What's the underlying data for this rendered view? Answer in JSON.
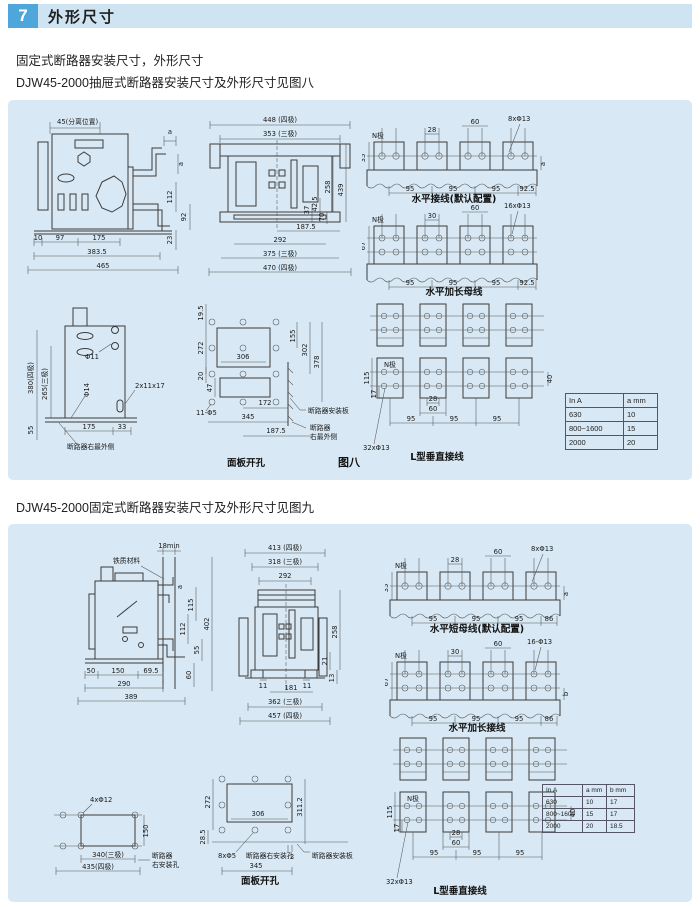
{
  "page": {
    "section_number": "7",
    "section_title": "外形尺寸",
    "intro_line1": "固定式断路器安装尺寸，外形尺寸",
    "intro_line2": "DJW45-2000抽屉式断路器安装尺寸及外形尺寸见图八",
    "mid_line": "DJW45-2000固定式断路器安装尺寸及外形尺寸见图九"
  },
  "colors": {
    "accent": "#4fa6da",
    "header_bg": "#cfe4f2",
    "panel_bg": "#d8e9f5"
  },
  "fig8": {
    "caption": "图八",
    "side": {
      "sep": "45(分离位置)",
      "a1": "a",
      "a2": "a",
      "v112": "112",
      "v92": "92",
      "v23": "23",
      "b10": "10",
      "b97": "97",
      "b175": "175",
      "b383": "383.5",
      "b465": "465"
    },
    "front": {
      "w4": "448 (四极)",
      "w3": "353 (三极)",
      "h258": "258",
      "h439": "439",
      "h37": "37",
      "h425": "42.5",
      "h70": "70",
      "b187": "187.5",
      "b292": "292",
      "b375": "375 (三极)",
      "b470": "470 (四极)"
    },
    "hdef": {
      "title": "水平接线(默认配置)",
      "n": "N极",
      "d28": "28",
      "d60": "60",
      "holes": "8xΦ13",
      "left": "35",
      "a": "a",
      "p1": "95",
      "p2": "95",
      "p3": "95",
      "p4": "92.5"
    },
    "hext": {
      "title": "水平加长母线",
      "n": "N极",
      "d30": "30",
      "d60": "60",
      "holes": "16xΦ13",
      "left": "67",
      "p1": "95",
      "p2": "95",
      "p3": "95",
      "p4": "92.5"
    },
    "lvert": {
      "title": "L型垂直接线",
      "n": "N极",
      "v115": "115",
      "v17": "17",
      "v40": "40",
      "holes": "32xΦ13",
      "d28": "28",
      "d60": "60",
      "p1": "95",
      "p2": "95",
      "p3": "95"
    },
    "mount": {
      "v380": "380(四极)",
      "v265": "265(三极)",
      "v55": "55",
      "phi11": "Φ11",
      "phi14": "Φ14",
      "slot": "2x11x17",
      "b175": "175",
      "b33": "33",
      "note": "断路器右最外侧"
    },
    "cutout": {
      "title": "面板开孔",
      "l195": "19.5",
      "l272": "272",
      "l20": "20",
      "l47": "47",
      "r155": "155",
      "r302": "302",
      "r378": "378",
      "d306": "306",
      "d172": "172",
      "d345": "345",
      "d187": "187.5",
      "holes": "11-Φ5",
      "note1": "断路器安装板",
      "note2a": "断路器",
      "note2b": "右最外侧"
    },
    "table": {
      "h1": "In A",
      "h2": "a mm",
      "rows": [
        [
          "630",
          "10"
        ],
        [
          "800~1600",
          "15"
        ],
        [
          "2000",
          "20"
        ]
      ]
    }
  },
  "fig9": {
    "side": {
      "t18": "18min",
      "mat": "铁质材料",
      "a": "a",
      "v115": "115",
      "v402": "402",
      "v112": "112",
      "v55": "55",
      "v60": "60",
      "b50": "50",
      "b150": "150",
      "b695": "69.5",
      "b290": "290",
      "b389": "389"
    },
    "front": {
      "w4": "413 (四极)",
      "w3": "318 (三极)",
      "w292": "292",
      "h258": "258",
      "h21": "21",
      "h13": "13",
      "d11a": "11",
      "d11b": "11",
      "d181": "181",
      "b362": "362 (三极)",
      "b457": "457 (四极)"
    },
    "hdef": {
      "title": "水平短母线(默认配置)",
      "n": "N极",
      "d28": "28",
      "d60": "60",
      "holes": "8xΦ13",
      "left": "35",
      "a": "a",
      "p1": "95",
      "p2": "95",
      "p3": "95",
      "p4": "86"
    },
    "hext": {
      "title": "水平加长接线",
      "n": "N极",
      "d30": "30",
      "d60": "60",
      "holes": "16-Φ13",
      "left": "67",
      "b": "b",
      "p1": "95",
      "p2": "95",
      "p3": "95",
      "p4": "86"
    },
    "lvert": {
      "title": "L型垂直接线",
      "n": "N极",
      "v115": "115",
      "v17": "17",
      "v40": "40",
      "holes": "32xΦ13",
      "d28": "28",
      "d60": "60",
      "p1": "95",
      "p2": "95",
      "p3": "95"
    },
    "mount": {
      "holes": "4xΦ12",
      "v150": "150",
      "b340": "340(三极)",
      "b435": "435(四极)",
      "note1": "断路器",
      "note2": "右安装孔"
    },
    "cutout": {
      "title": "面板开孔",
      "l272": "272",
      "l285": "28.5",
      "d306": "306",
      "r311": "311.2",
      "holes": "8xΦ5",
      "noteA": "断路器右安装孔",
      "d2": "2",
      "noteB": "断路器安装板",
      "d345": "345"
    },
    "table": {
      "h1": "In A",
      "h2": "a mm",
      "h3": "b mm",
      "rows": [
        [
          "630",
          "10",
          "17"
        ],
        [
          "800~1600",
          "15",
          "17"
        ],
        [
          "2000",
          "20",
          "18.5"
        ]
      ]
    }
  }
}
